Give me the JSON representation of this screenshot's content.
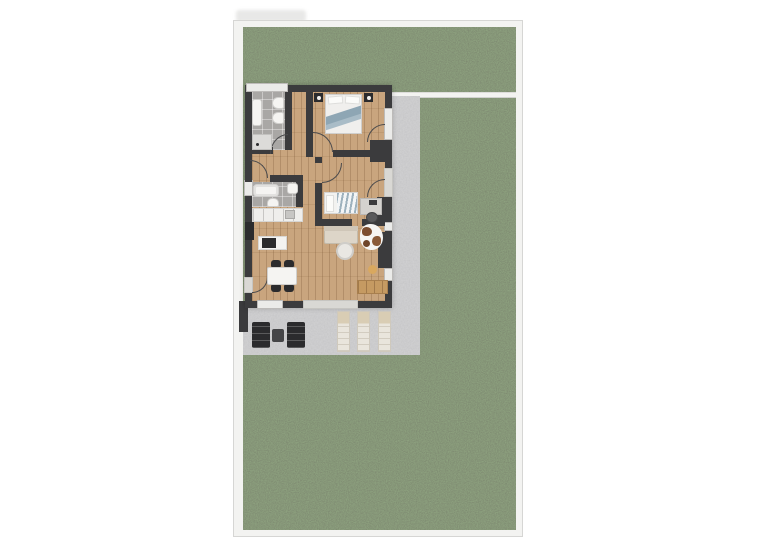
{
  "scene": {
    "type": "floor-plan",
    "view": "top-down 3D render",
    "description": "Apartment floor plan on a garden plot with lawn, white edging, concrete side path and terrace"
  },
  "colors": {
    "page_bg": "#ffffff",
    "plot_border": "#f3f3f1",
    "plot_border_edge": "#d6d6d4",
    "grass_base": "#3e4e31",
    "paving": "#9b9b9d",
    "wall": "#3b3b3d",
    "wood": "#c9a57e",
    "tile": "#a9a7a5",
    "window": "#ebebe9",
    "fixture": "#f5f4f2",
    "appliance": "#2b2b2d",
    "sofa": "#ddd5c8",
    "bed_accent": "#8ea6b4",
    "sideboard": "#c59a62",
    "lounger": "#e9e5dc",
    "lounger_head": "#d9cdb4",
    "out_dark": "#2b2b2d",
    "pouf": "#d9a85f",
    "cowhide_patch": "#7d4e30"
  },
  "apartment": {
    "rooms": [
      {
        "name": "bathroom-top",
        "floor": "gray tile",
        "fixtures": [
          "vanity-sink",
          "toilet",
          "bidet",
          "shower"
        ],
        "features": [
          "window-top-wall",
          "door-to-hallway"
        ]
      },
      {
        "name": "hallway",
        "floor": "wood"
      },
      {
        "name": "bedroom",
        "floor": "wood",
        "furniture": [
          "double-bed",
          "nightstand-left-with-lamp",
          "nightstand-right-with-lamp"
        ],
        "features": [
          "window-right-wall",
          "door-to-side-path",
          "door-to-hallway"
        ]
      },
      {
        "name": "bathroom-lower",
        "floor": "gray tile",
        "fixtures": [
          "bathtub",
          "washbasin",
          "toilet"
        ],
        "features": [
          "window-left-wall",
          "door-to-hall"
        ]
      },
      {
        "name": "kitchen",
        "floor": "wood",
        "furniture": [
          "counter-run",
          "tall-appliance",
          "island-with-cooktop"
        ]
      },
      {
        "name": "dining-area",
        "floor": "wood",
        "furniture": [
          "dining-table",
          "chair",
          "chair",
          "chair",
          "chair"
        ],
        "features": [
          "entrance-door-left-wall",
          "window-bottom-wall"
        ]
      },
      {
        "name": "study-bedroom",
        "floor": "wood",
        "furniture": [
          "daybed-striped-duvet",
          "desk",
          "office-chair"
        ],
        "features": [
          "door-to-side-path"
        ]
      },
      {
        "name": "living-area",
        "floor": "wood",
        "furniture": [
          "sofa",
          "cowhide-rug",
          "round-rug",
          "pouf",
          "sideboard"
        ],
        "features": [
          "sliding-door-to-terrace"
        ]
      }
    ]
  },
  "outdoor": {
    "lawn": "grass surrounding plot",
    "edging": "white border strip around plot and separator line right of house",
    "side_path": "concrete strip along right side of apartment",
    "terrace": {
      "paving": "concrete",
      "furniture": [
        "lounge-chair-dark",
        "side-table-dark",
        "lounge-chair-dark",
        "sun-lounger",
        "sun-lounger",
        "sun-lounger"
      ],
      "privacy_wall": "dark wall stub at left edge"
    }
  }
}
